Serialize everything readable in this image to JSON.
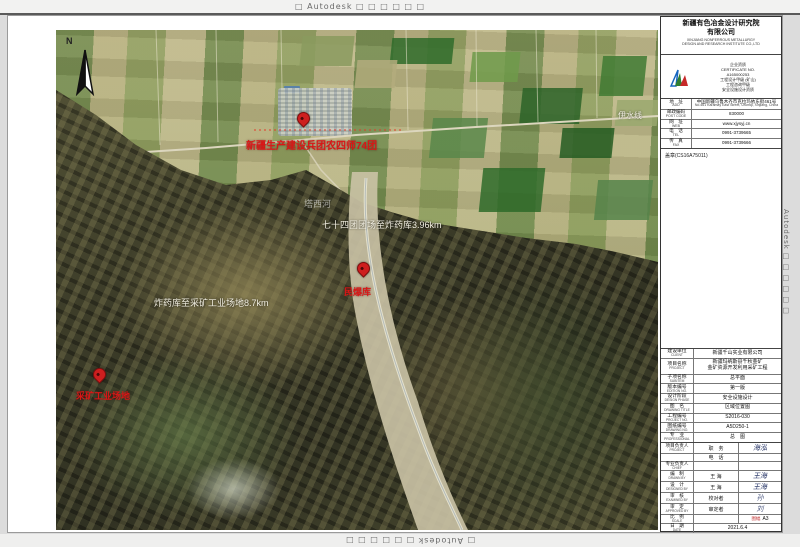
{
  "watermarks": {
    "top": "□ Autodesk □ □ □ □ □ □",
    "bottom": "□ Autodesk □ □ □ □ □ □",
    "left": "Autodesk □ □ □ □ □ □",
    "right": "Autodesk □ □ □ □ □ □"
  },
  "map": {
    "north_label": "N",
    "annotations": {
      "town_label": "新疆生产建设兵团农四师74团",
      "route1_label": "七十四团团场至炸药库3.96km",
      "river_label": "塔西河",
      "depot_label": "民爆库",
      "route2_label": "炸药库至采矿工业场地8.7km",
      "site_label": "采矿工业场地",
      "road_label": "伊水线"
    }
  },
  "titleblock": {
    "company_cn1": "新疆有色冶金设计研究院",
    "company_cn2": "有限公司",
    "company_en1": "XINJIANG NONFERROUS METALLURGY",
    "company_en2": "DESIGN AND RESEARCH INSTITUTE CO.,LTD",
    "cert_lines": {
      "0": "企业资质",
      "1": "CERTIFICATE NO.",
      "2": "A165000253",
      "3": "工程设计甲级 (矿山)",
      "4": "工程咨询甲级",
      "5": "安全设施设计资质"
    },
    "address_rows": {
      "0": {
        "label": "地　址",
        "sub": "ADD",
        "value": "中国新疆乌鲁木齐市克拉玛依东街461号",
        "sub_value": "No.461 Karamay East Street, Urumqi, Xinjiang, China"
      },
      "1": {
        "label": "邮政编码",
        "sub": "POST CODE",
        "value": "830000"
      },
      "2": {
        "label": "网　址",
        "sub": "WEB",
        "value": "www.xjysyj.cn"
      },
      "3": {
        "label": "电　话",
        "sub": "TEL",
        "value": "0991-3739665"
      },
      "4": {
        "label": "传　真",
        "sub": "FAX",
        "value": "0991-3739666"
      }
    },
    "stamp_note": "盖章(CS16A75011)",
    "info_rows": {
      "0": {
        "l": "建设单位",
        "e": "CLIENT",
        "v": "新疆千山实业有限公司"
      },
      "1": {
        "l": "项目名称",
        "e": "PROJECT",
        "v": "新疆玛纳斯县千秋金矿",
        "v2": "金矿资源开发利用采矿工程"
      },
      "2": {
        "l": "子项名称",
        "e": "SUBITEM",
        "v": "总平面"
      },
      "3": {
        "l": "版本编号",
        "e": "EDITION NO.",
        "v": "第一版"
      },
      "4": {
        "l": "设计阶段",
        "e": "DESIGN PHASE",
        "v": "安全设施设计"
      },
      "5": {
        "l": "图　名",
        "e": "DRAWING TITLE",
        "v": "区域位置图"
      },
      "6": {
        "l": "工程编号",
        "e": "PROJECT NO.",
        "v": "S2016-030"
      },
      "7": {
        "l": "图纸编号",
        "e": "DRAWING NO.",
        "v": "A5D250-1"
      },
      "8": {
        "l": "专　业",
        "e": "PROFESSIONAL",
        "v": "总　图"
      }
    },
    "sig_rows": {
      "0": {
        "l": "项目负责人",
        "e": "PROJECT",
        "m": "职　务",
        "sig": "海泓"
      },
      "1": {
        "l": "",
        "e": "",
        "m": "电　话",
        "sig": ""
      },
      "2": {
        "l": "专业负责人",
        "e": "CHIEF",
        "m": "",
        "sig": ""
      },
      "3": {
        "l": "编　制",
        "e": "DRAWN BY",
        "m": "王 海",
        "sig": "王海"
      },
      "4": {
        "l": "设　计",
        "e": "DESIGNED BY",
        "m": "王 海",
        "sig": "王海"
      },
      "5": {
        "l": "审　核",
        "e": "EXAMINED BY",
        "m": "校对者",
        "sig": "孙"
      },
      "6": {
        "l": "审　定",
        "e": "APPROVED BY",
        "m": "审定者",
        "sig": "刘"
      },
      "7": {
        "l": "比　例",
        "e": "SCALE",
        "m": "",
        "sig_prefix": "图幅",
        "sig": "A3"
      },
      "8": {
        "l": "日　期",
        "e": "DATE",
        "m": "2021.6.4",
        "sig": ""
      }
    }
  }
}
